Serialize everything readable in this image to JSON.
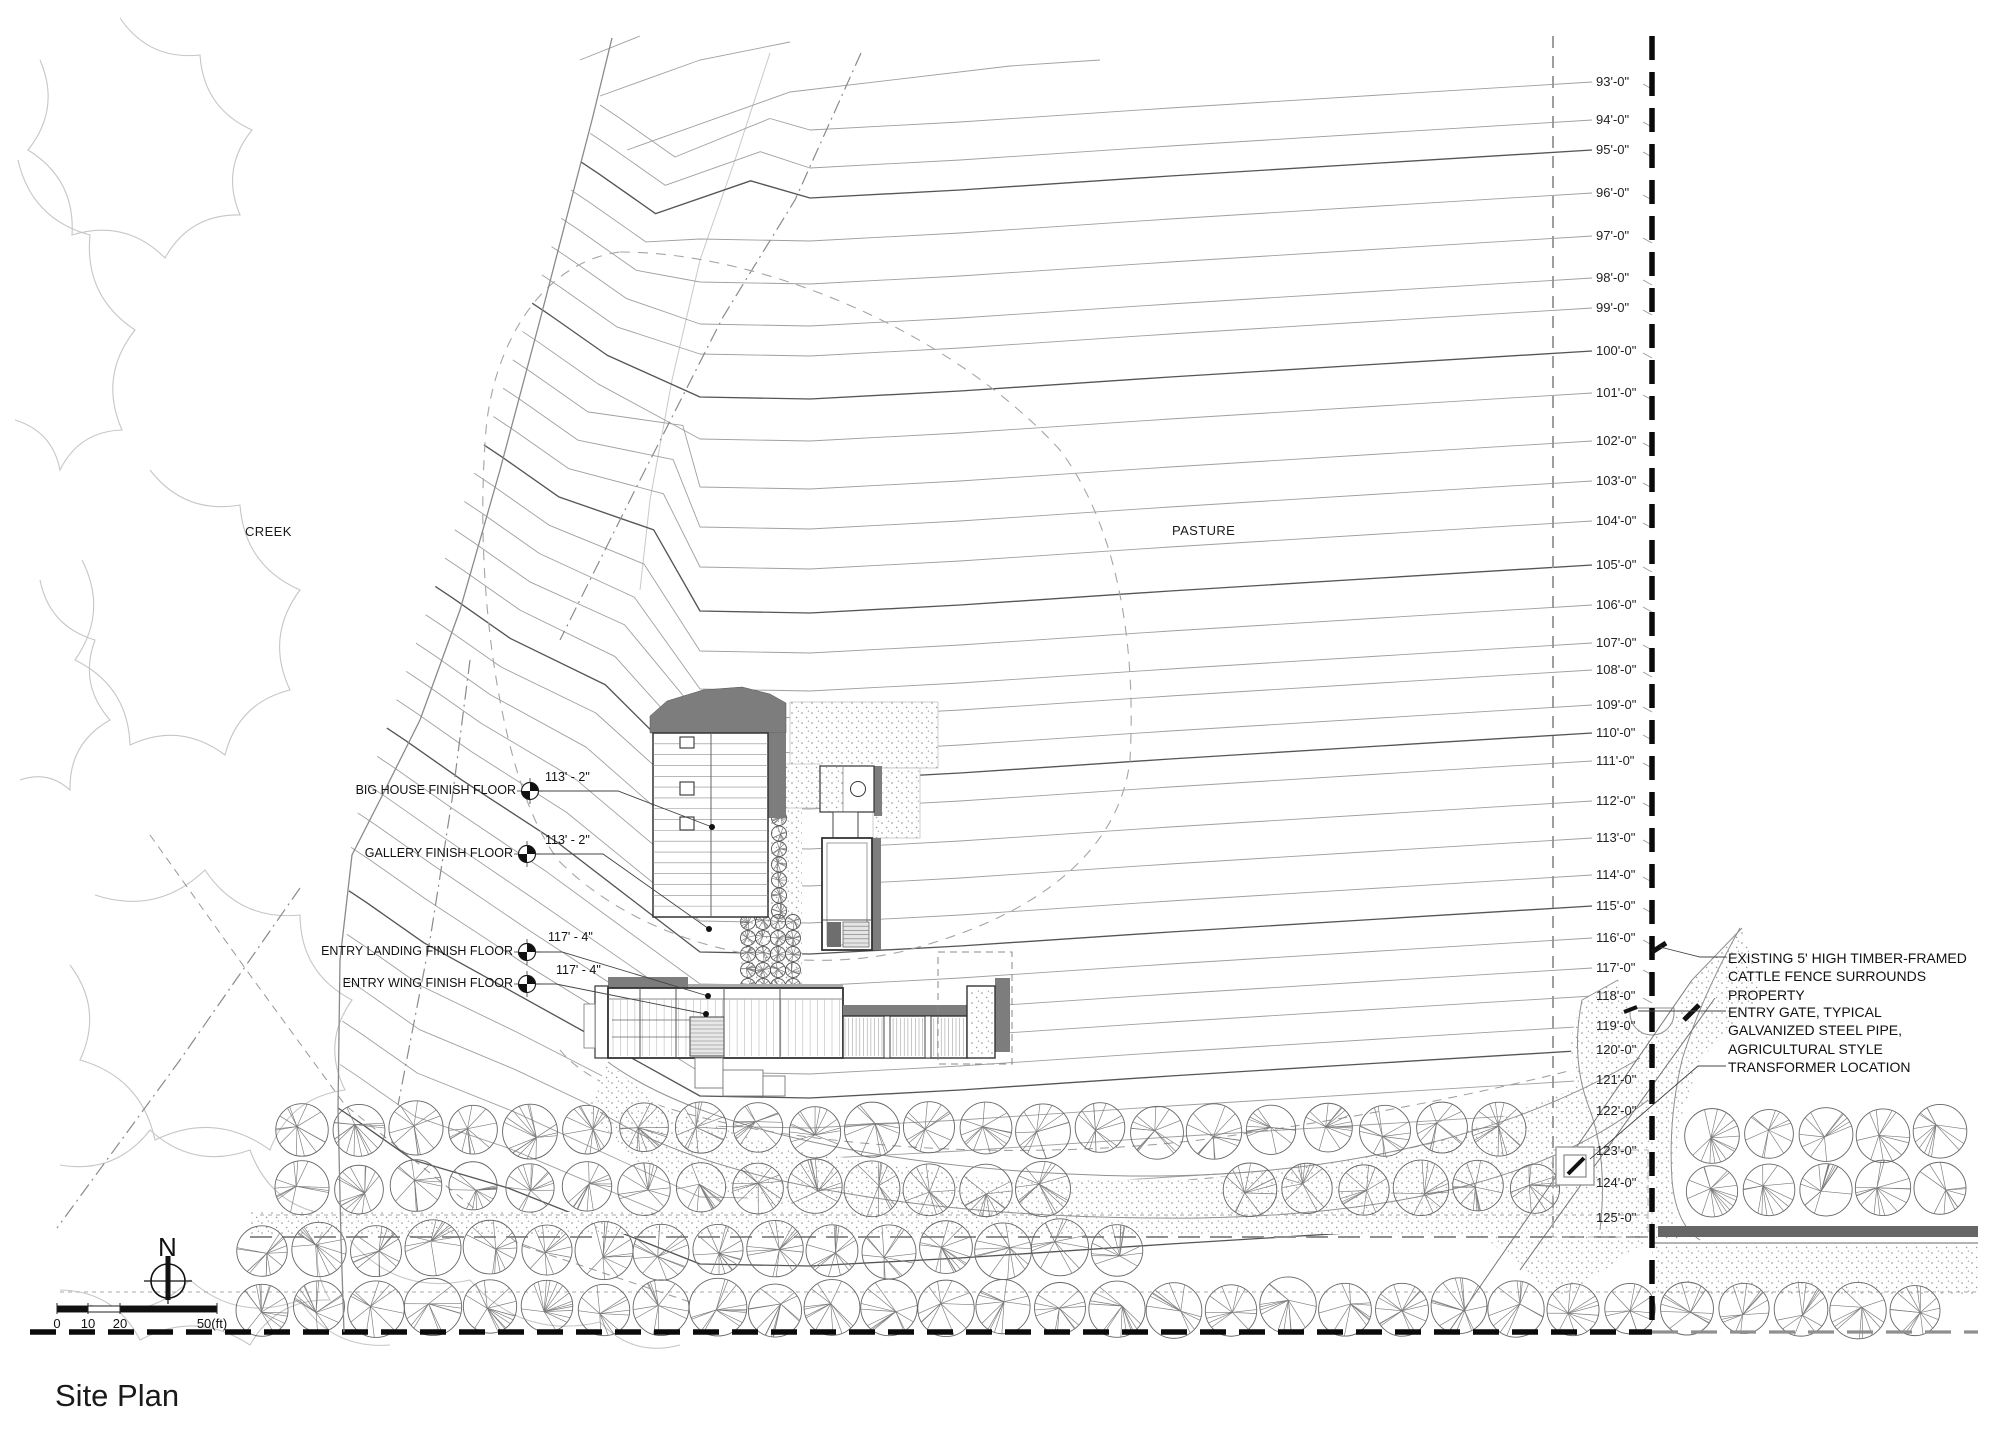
{
  "sheet": {
    "title": "Site Plan"
  },
  "map_labels": {
    "creek": "CREEK",
    "pasture": "PASTURE"
  },
  "north_arrow": {
    "label": "N"
  },
  "scale_bar": {
    "ticks": [
      {
        "label": "0",
        "x": 57
      },
      {
        "label": "10",
        "x": 88
      },
      {
        "label": "20",
        "x": 120
      },
      {
        "label": "50(ft)",
        "x": 212
      }
    ]
  },
  "contour_labels": [
    {
      "label": "93'-0\"",
      "y": 82
    },
    {
      "label": "94'-0\"",
      "y": 120
    },
    {
      "label": "95'-0\"",
      "y": 150
    },
    {
      "label": "96'-0\"",
      "y": 193
    },
    {
      "label": "97'-0\"",
      "y": 236
    },
    {
      "label": "98'-0\"",
      "y": 278
    },
    {
      "label": "99'-0\"",
      "y": 308
    },
    {
      "label": "100'-0\"",
      "y": 351
    },
    {
      "label": "101'-0\"",
      "y": 393
    },
    {
      "label": "102'-0\"",
      "y": 441
    },
    {
      "label": "103'-0\"",
      "y": 481
    },
    {
      "label": "104'-0\"",
      "y": 521
    },
    {
      "label": "105'-0\"",
      "y": 565
    },
    {
      "label": "106'-0\"",
      "y": 605
    },
    {
      "label": "107'-0\"",
      "y": 643
    },
    {
      "label": "108'-0\"",
      "y": 670
    },
    {
      "label": "109'-0\"",
      "y": 705
    },
    {
      "label": "110'-0\"",
      "y": 733
    },
    {
      "label": "111'-0\"",
      "y": 761
    },
    {
      "label": "112'-0\"",
      "y": 801
    },
    {
      "label": "113'-0\"",
      "y": 838
    },
    {
      "label": "114'-0\"",
      "y": 875
    },
    {
      "label": "115'-0\"",
      "y": 906
    },
    {
      "label": "116'-0\"",
      "y": 938
    },
    {
      "label": "117'-0\"",
      "y": 968
    },
    {
      "label": "118'-0\"",
      "y": 996
    },
    {
      "label": "119'-0\"",
      "y": 1026
    },
    {
      "label": "120'-0\"",
      "y": 1050
    },
    {
      "label": "121'-0\"",
      "y": 1080
    },
    {
      "label": "122'-0\"",
      "y": 1111
    },
    {
      "label": "123'-0\"",
      "y": 1151
    },
    {
      "label": "124'-0\"",
      "y": 1183
    },
    {
      "label": "125'-0\"",
      "y": 1218
    }
  ],
  "floor_annotations": [
    {
      "label": "BIG HOUSE FINISH FLOOR",
      "value": "113' - 2\"",
      "sx": 530,
      "sy": 791,
      "mid": 618,
      "dx": 712,
      "dy": 827,
      "vx": 545,
      "vy": 784
    },
    {
      "label": "GALLERY FINISH FLOOR",
      "value": "113' - 2\"",
      "sx": 527,
      "sy": 854,
      "mid": 603,
      "dx": 709,
      "dy": 929,
      "vx": 545,
      "vy": 847
    },
    {
      "label": "ENTRY LANDING FINISH FLOOR",
      "value": "117' - 4\"",
      "sx": 527,
      "sy": 952,
      "mid": 562,
      "dx": 708,
      "dy": 996,
      "vx": 548,
      "vy": 944
    },
    {
      "label": "ENTRY WING FINISH FLOOR",
      "value": "117' - 4\"",
      "sx": 527,
      "sy": 984,
      "mid": 556,
      "dx": 706,
      "dy": 1014,
      "vx": 556,
      "vy": 977
    }
  ],
  "callouts": [
    {
      "name": "fence-note",
      "lines": [
        "EXISTING 5' HIGH TIMBER-FRAMED",
        "CATTLE FENCE SURROUNDS",
        "PROPERTY"
      ],
      "x": 1728,
      "y": 949,
      "leader": [
        [
          1726,
          957
        ],
        [
          1700,
          957
        ],
        [
          1660,
          947
        ]
      ]
    },
    {
      "name": "entry-gate-note",
      "lines": [
        "ENTRY GATE, TYPICAL",
        "GALVANIZED STEEL PIPE,",
        "AGRICULTURAL STYLE"
      ],
      "x": 1728,
      "y": 1003,
      "leader": [
        [
          1726,
          1011
        ],
        [
          1638,
          1011
        ]
      ]
    },
    {
      "name": "transformer-note",
      "lines": [
        "TRANSFORMER LOCATION"
      ],
      "x": 1728,
      "y": 1058,
      "leader": [
        [
          1726,
          1066
        ],
        [
          1698,
          1066
        ],
        [
          1590,
          1159
        ]
      ]
    }
  ],
  "tree_rows": [
    {
      "y": 1130,
      "x0": 302,
      "x1": 1540,
      "step": 57,
      "r": 26
    },
    {
      "y": 1188,
      "x0": 302,
      "x1": 1070,
      "step": 57,
      "r": 26
    },
    {
      "y": 1188,
      "x0": 1250,
      "x1": 1545,
      "step": 57,
      "r": 26
    },
    {
      "y": 1250,
      "x0": 262,
      "x1": 1160,
      "step": 57,
      "r": 27
    },
    {
      "y": 1308,
      "x0": 262,
      "x1": 1955,
      "step": 57,
      "r": 27
    },
    {
      "y": 1133,
      "x0": 1712,
      "x1": 1955,
      "step": 57,
      "r": 26
    },
    {
      "y": 1190,
      "x0": 1712,
      "x1": 1955,
      "step": 57,
      "r": 26
    }
  ],
  "courtyard_trees": {
    "column": {
      "x": 779,
      "y0": 818,
      "step": 15.5,
      "count": 7,
      "r": 7.5
    },
    "block": {
      "cols": [
        748,
        763,
        778,
        793
      ],
      "rows": [
        922,
        938,
        954,
        970,
        986
      ],
      "r": 7.5
    }
  },
  "colors": {
    "contour": "#9f9f9f",
    "contour_index": "#555555",
    "shadow": "#7d7d7d",
    "road": "#666666",
    "ink": "#1a1a1a",
    "cloud": "#c6c6c6",
    "dash": "#8f8f8f"
  }
}
